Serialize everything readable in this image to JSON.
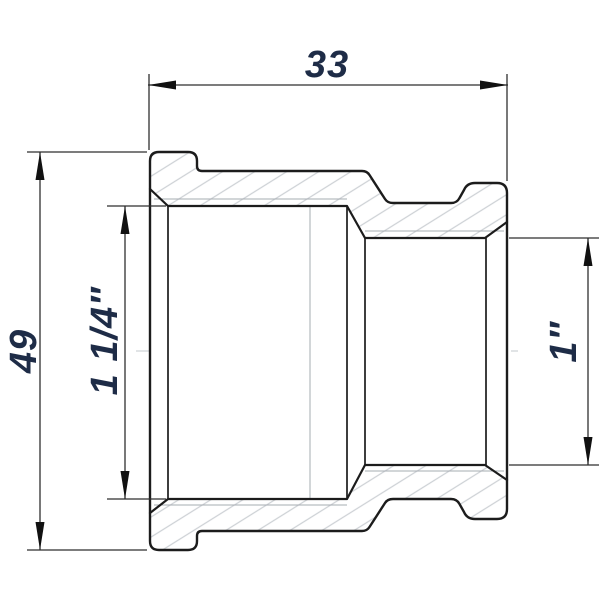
{
  "drawing": {
    "type": "technical-drawing",
    "part": "reducing-socket-cross-section",
    "labels": {
      "width": "33",
      "height": "49",
      "left_bore": "1 1/4″",
      "right_bore": "1″"
    },
    "colors": {
      "background": "#ffffff",
      "line": "#1c1c1c",
      "dimension": "#2f2f2f",
      "arrow": "#111111",
      "label_text": "#1e2c47",
      "hatch": "#cdd1d5",
      "thin_line": "#a6acb2",
      "centerline": "#c3c8cd"
    }
  }
}
